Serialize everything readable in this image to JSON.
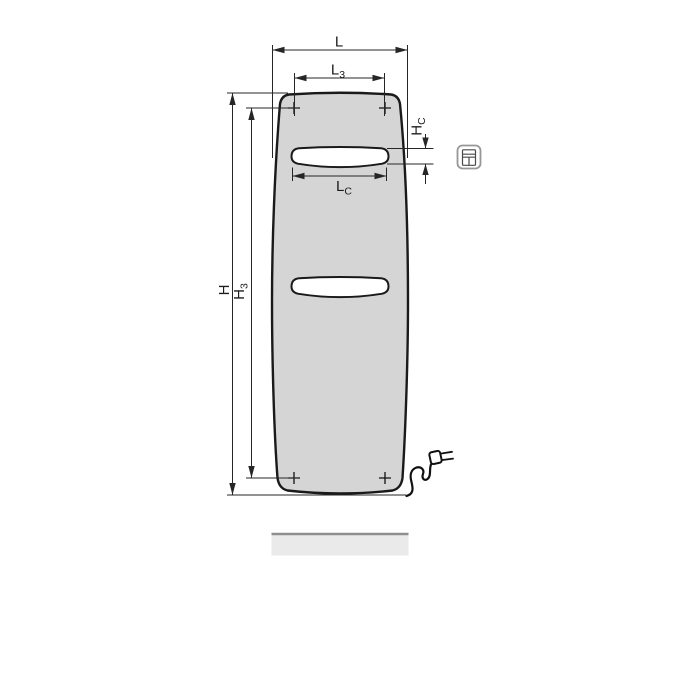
{
  "drawing": {
    "type": "technical-dimension-drawing",
    "subject": "flat panel radiator, front view, with two towel openings, four mounting marks, power cord with plug and floor shadow bar",
    "dimension_labels": {
      "L": {
        "main": "L",
        "sub": ""
      },
      "L3": {
        "main": "L",
        "sub": "3"
      },
      "H": {
        "main": "H",
        "sub": ""
      },
      "H3": {
        "main": "H",
        "sub": "3"
      },
      "HC": {
        "main": "H",
        "sub": "C"
      },
      "LC": {
        "main": "L",
        "sub": "C"
      }
    },
    "mounting_mark_symbol": "+",
    "mounting_mark_count": 4,
    "icons": {
      "legend": "radiator-front-with-towel-slot-icon"
    },
    "colors": {
      "background": "#ffffff",
      "panel_fill": "#d5d5d5",
      "panel_outline": "#1a1a1a",
      "dimension_line": "#262626",
      "slot_fill": "#ffffff",
      "floor_fill": "#eaeaea",
      "floor_edge": "#8f8f8f",
      "icon_border": "#979797",
      "icon_detail": "#4a4a4a"
    }
  }
}
